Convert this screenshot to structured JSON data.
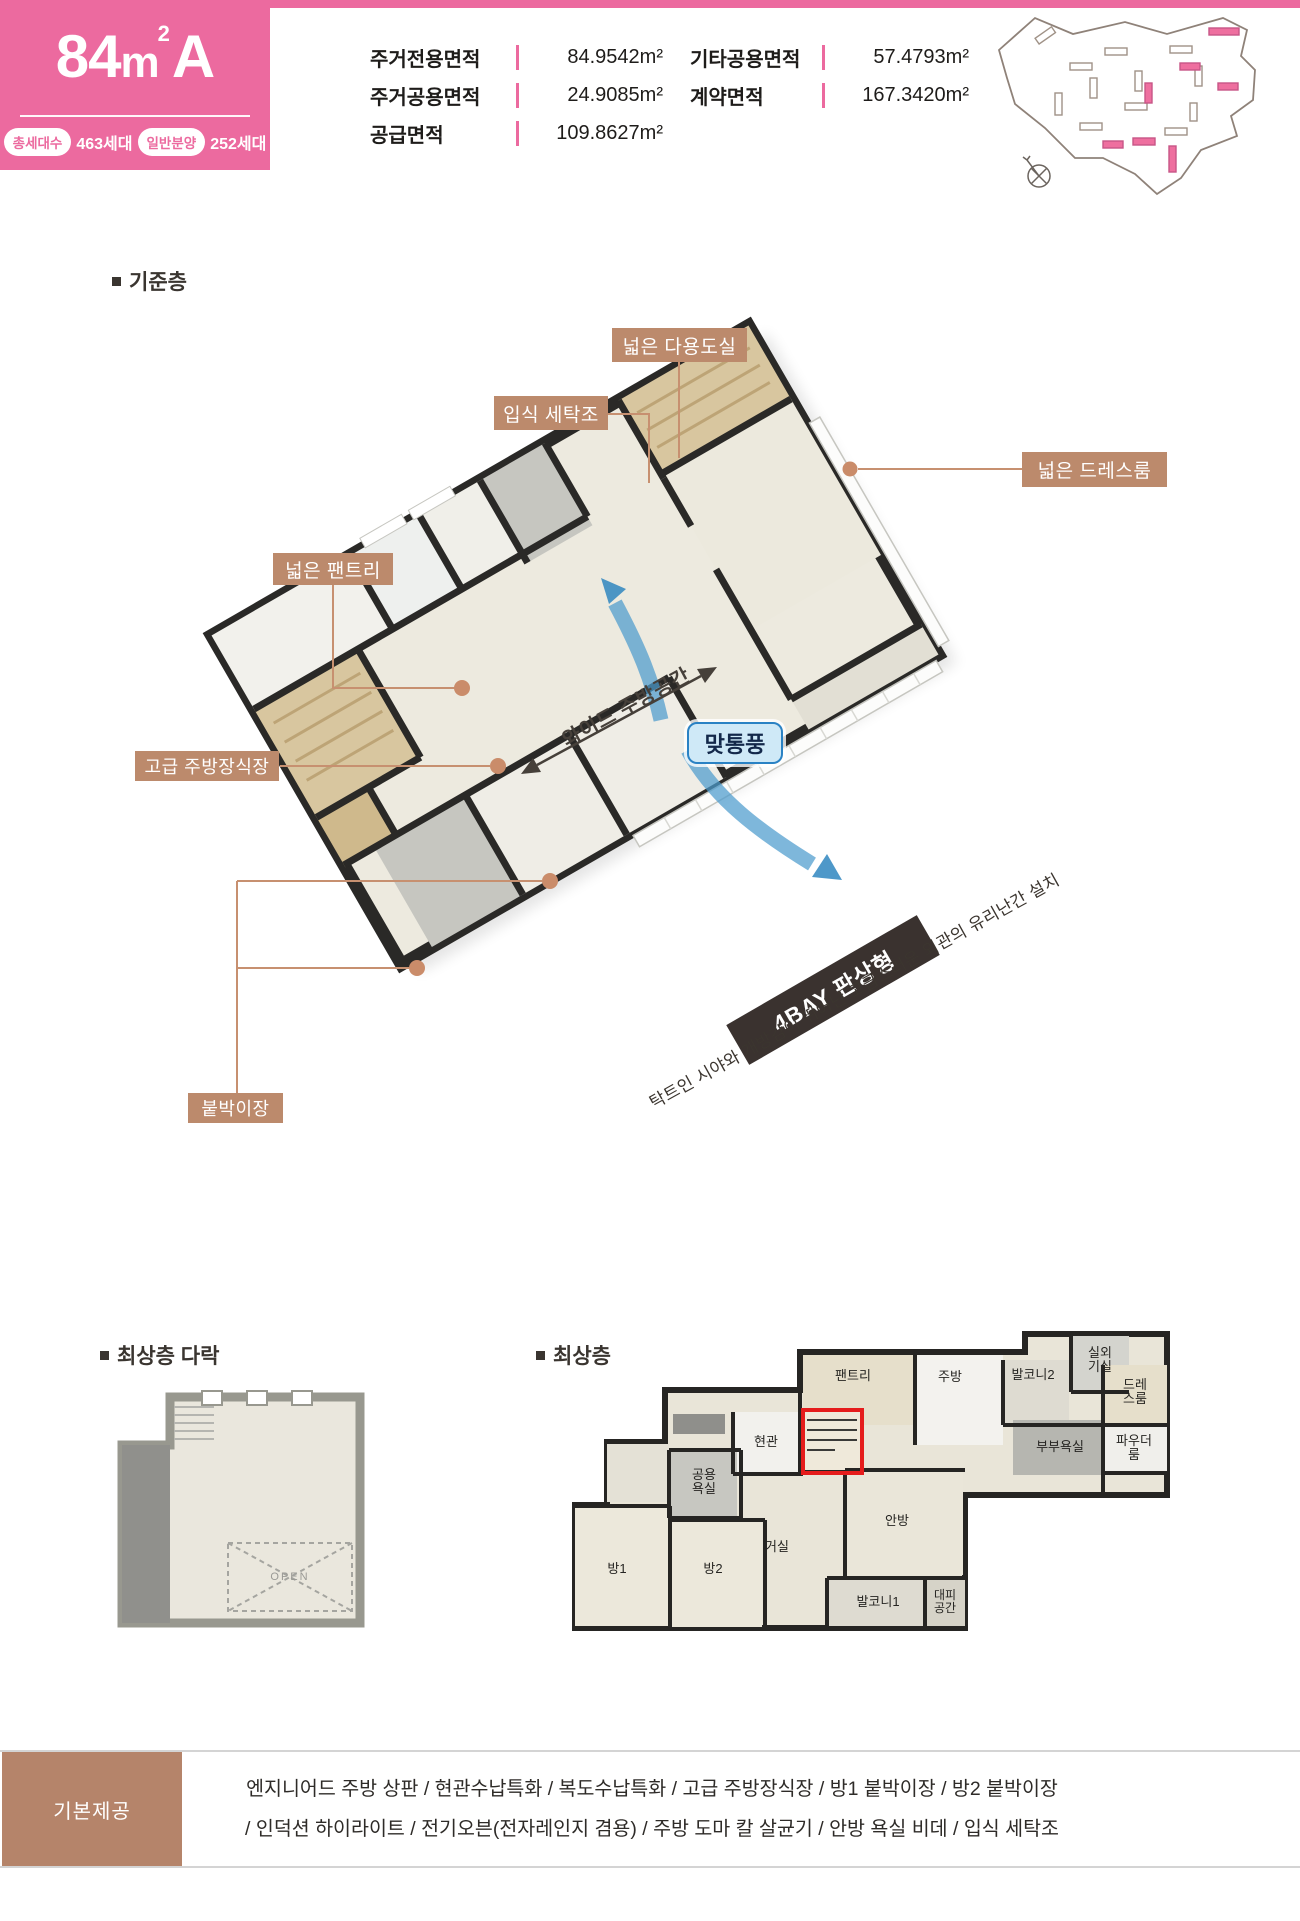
{
  "colors": {
    "brand_pink": "#ec6a9f",
    "callout_brown": "#bc8a6c",
    "leader_line": "#c79070",
    "ribbon_dark": "#3a322f",
    "flow_blue": "#3e93c9",
    "vent_badge_border": "#2a82c4",
    "stairs_highlight_red": "#e51c1c",
    "provision_brown": "#b5846a"
  },
  "header": {
    "type_number": "84",
    "type_unit": "m",
    "type_unit_sup": "2",
    "type_suffix": "A",
    "badges": [
      {
        "label": "총세대수",
        "value": "463세대"
      },
      {
        "label": "일반분양",
        "value": "252세대"
      }
    ],
    "areas_left": [
      {
        "label": "주거전용면적",
        "value": "84.9542m²"
      },
      {
        "label": "주거공용면적",
        "value": "24.9085m²"
      },
      {
        "label": "공급면적",
        "value": "109.8627m²"
      }
    ],
    "areas_right": [
      {
        "label": "기타공용면적",
        "value": "57.4793m²"
      },
      {
        "label": "계약면적",
        "value": "167.3420m²"
      }
    ]
  },
  "standard_floor": {
    "title": "기준층",
    "callouts": {
      "utility": "넓은 다용도실",
      "laundry": "입식 세탁조",
      "dressroom": "넓은 드레스룸",
      "pantry": "넓은 팬트리",
      "kitchen_cabinet": "고급 주방장식장",
      "closet": "붙박이장"
    },
    "kitchen_span_label": "와이드 주방공간",
    "cross_vent_badge": "맞통풍",
    "bay_ribbon": "4BAY 판상형",
    "glass_rail_note": "탁트인 시야와 개방감이 뛰어난 고급스러운 외관의 유리난간 설치"
  },
  "attic": {
    "title": "최상층 다락",
    "open_label": "OPEN"
  },
  "top_floor": {
    "title": "최상층",
    "rooms": {
      "pantry": "팬트리",
      "kitchen": "주방",
      "balcony2": "발코니2",
      "outdoor_unit": "실외기실",
      "dressroom": "드레스룸",
      "entrance": "현관",
      "public_bath": "공용욕실",
      "master_bath": "부부욕실",
      "powder": "파우더룸",
      "master": "안방",
      "living": "거실",
      "room1": "방1",
      "room2": "방2",
      "balcony1": "발코니1",
      "shelter": "대피공간"
    }
  },
  "provision": {
    "title": "기본제공",
    "line1": "엔지니어드 주방 상판 / 현관수납특화 / 복도수납특화 / 고급 주방장식장 / 방1 붙박이장 / 방2 붙박이장",
    "line2": "/ 인덕션 하이라이트 / 전기오븐(전자레인지 겸용) / 주방 도마 칼 살균기 / 안방 욕실 비데  /  입식 세탁조"
  }
}
